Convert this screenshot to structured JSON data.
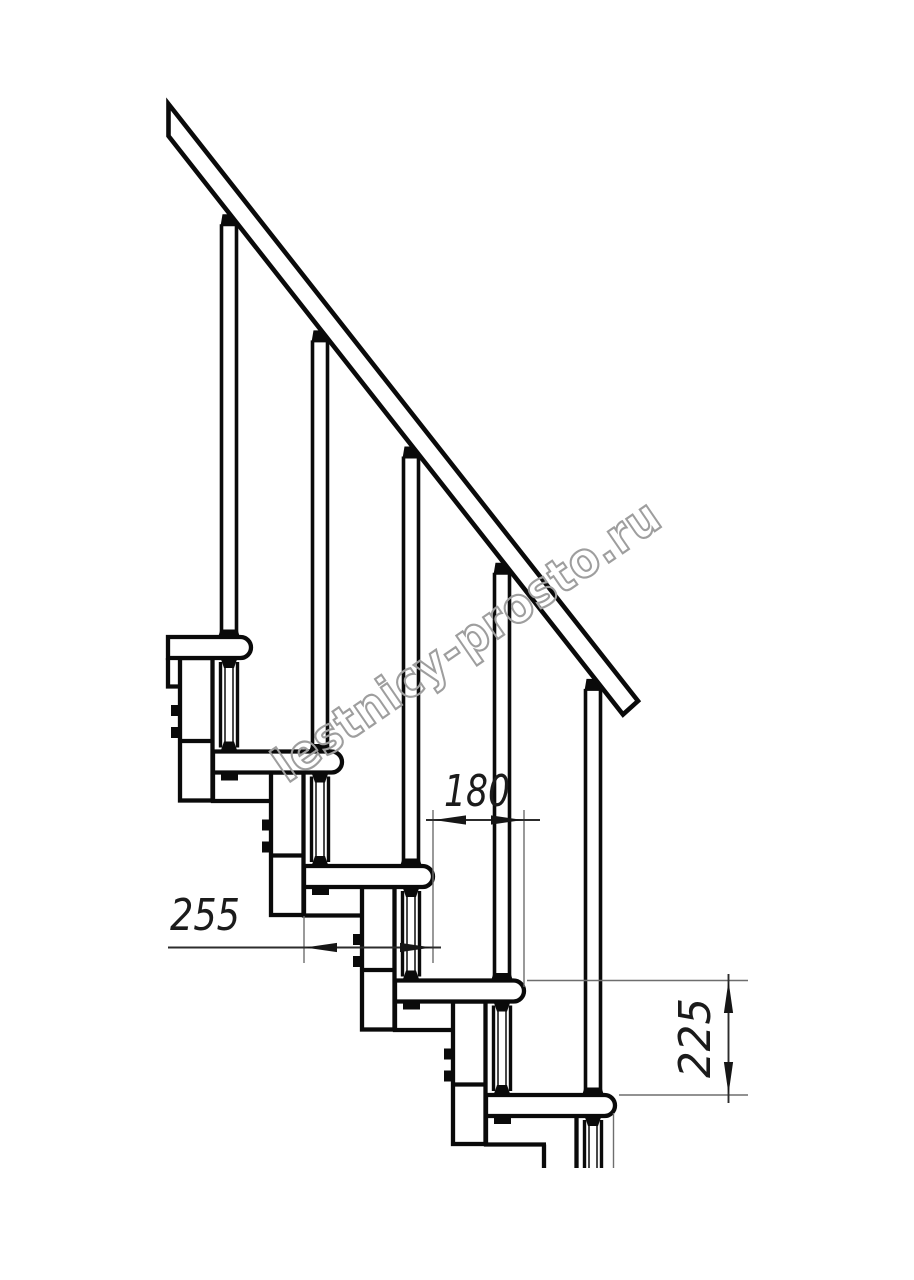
{
  "drawing": {
    "type": "staircase-side-elevation",
    "steps": 5,
    "dimensions": [
      {
        "id": "step-run",
        "label": "180",
        "orientation": "horizontal"
      },
      {
        "id": "tread-depth",
        "label": "255",
        "orientation": "horizontal"
      },
      {
        "id": "step-rise",
        "label": "225",
        "orientation": "vertical"
      }
    ],
    "watermark": {
      "text": "lestnicy-prosto.ru",
      "color": "#9e9e9e"
    },
    "colors": {
      "line": "#0a0a0a",
      "dimension": "#2c2c2c",
      "extension": "#6e6e6e",
      "background": "#ffffff"
    }
  }
}
